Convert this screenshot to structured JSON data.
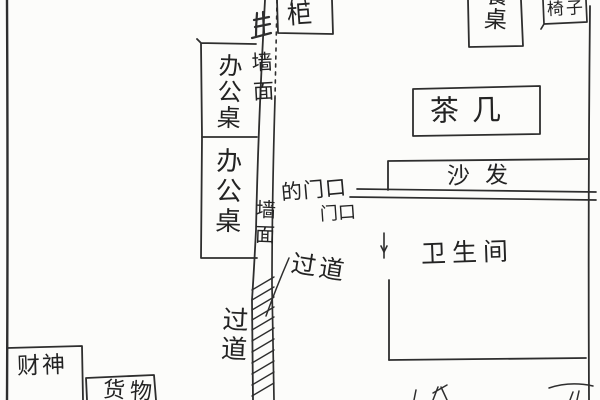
{
  "meta": {
    "description": "hand-drawn floor plan sketch, pencil on white paper",
    "ink_color": "#2e2e2e",
    "paper_color": "#fcfcfa"
  },
  "labels": {
    "wall_top": "墙面",
    "wall_mid": "墙面",
    "cabinet": "柜",
    "desk_upper": "办公桌",
    "desk_lower": "办公桌",
    "dining_table": "餐桌",
    "chair": "椅子",
    "tea_table": "茶几",
    "sofa": "沙发",
    "bathroom": "卫生间",
    "door_entry": "的门口",
    "door": "门口",
    "corridor_upper": "过道",
    "corridor_lower": "过道",
    "wealth_god": "财神",
    "goods": "货物"
  }
}
